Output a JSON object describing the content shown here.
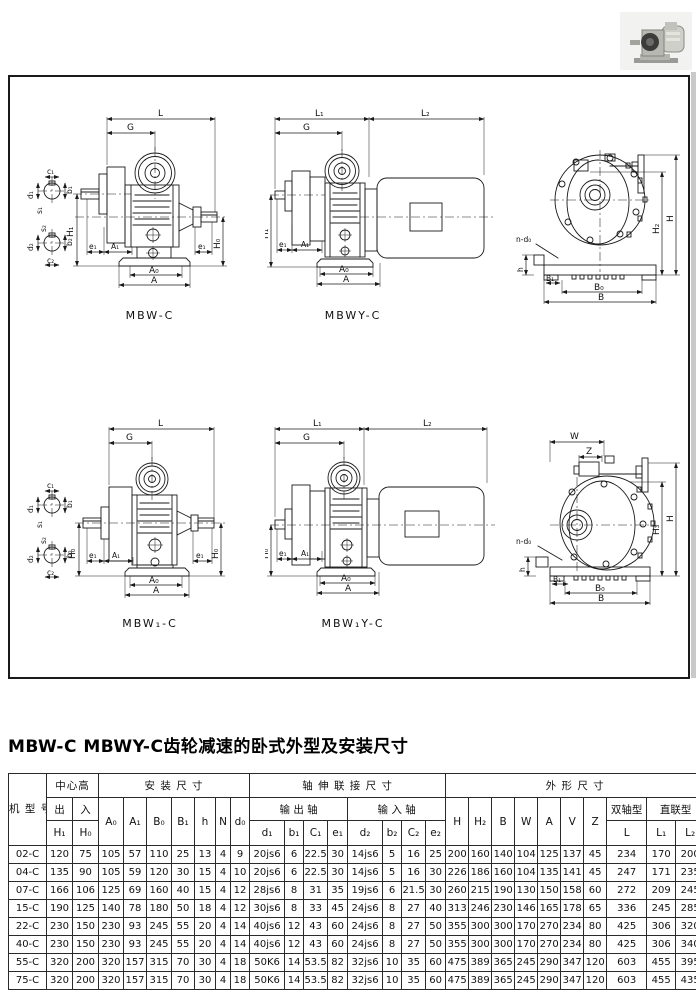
{
  "title": "MBW-C MBWY-C齿轮减速的卧式外型及安装尺寸",
  "photo": {
    "name": "gear-motor-product-photo"
  },
  "captions": {
    "mbw": "MBW-C",
    "mbwy": "MBWY-C",
    "mbw1": "MBW₁-C",
    "mbw1y": "MBW₁Y-C"
  },
  "dims": {
    "L": "L",
    "L1": "L₁",
    "L2": "L₂",
    "G": "G",
    "H1": "H₁",
    "H0": "H₀",
    "H": "H",
    "H2": "H₂",
    "H3": "H₃",
    "A": "A",
    "A0": "A₀",
    "A1": "A₁",
    "B": "B",
    "B0": "B₀",
    "B1": "B₁",
    "e1": "e₁",
    "W": "W",
    "Z": "Z",
    "h": "h",
    "n_d0": "n-d₀",
    "c1": "c₁",
    "b1": "b₁",
    "d1": "d₁",
    "s1": "s₁",
    "c2": "c₂",
    "b2": "b₂",
    "d2": "d₂",
    "s2": "s₂"
  },
  "table": {
    "groups": {
      "model": "机\n型\n号",
      "center_height": "中心高",
      "install": "安 装 尺 寸",
      "shaft": "轴 伸 联 接 尺 寸",
      "outline": "外 形 尺 寸",
      "out": "出",
      "in": "入",
      "output_shaft": "输 出 轴",
      "input_shaft": "输 入 轴",
      "double_shaft": "双轴型",
      "direct_type": "直联型"
    },
    "cols": {
      "h1": "H₁",
      "h0": "H₀",
      "a0": "A₀",
      "a1": "A₁",
      "b0": "B₀",
      "b1": "B₁",
      "h": "h",
      "n": "N",
      "d0": "d₀",
      "d1": "d₁",
      "b1s": "b₁",
      "c1": "C₁",
      "e1": "e₁",
      "d2": "d₂",
      "b2": "b₂",
      "c2": "C₂",
      "e2": "e₂",
      "H": "H",
      "H2": "H₂",
      "B": "B",
      "W": "W",
      "A": "A",
      "V": "V",
      "Z": "Z",
      "L": "L",
      "L1": "L₁",
      "L2": "L₂"
    },
    "rows": [
      [
        "02-C",
        "120",
        "75",
        "105",
        "57",
        "110",
        "25",
        "13",
        "4",
        "9",
        "20js6",
        "6",
        "22.5",
        "30",
        "14js6",
        "5",
        "16",
        "25",
        "200",
        "160",
        "140",
        "104",
        "125",
        "137",
        "45",
        "234",
        "170",
        "200"
      ],
      [
        "04-C",
        "135",
        "90",
        "105",
        "59",
        "120",
        "30",
        "15",
        "4",
        "10",
        "20js6",
        "6",
        "22.5",
        "30",
        "14js6",
        "5",
        "16",
        "30",
        "226",
        "186",
        "160",
        "104",
        "135",
        "141",
        "45",
        "247",
        "171",
        "235"
      ],
      [
        "07-C",
        "166",
        "106",
        "125",
        "69",
        "160",
        "40",
        "15",
        "4",
        "12",
        "28js6",
        "8",
        "31",
        "35",
        "19js6",
        "6",
        "21.5",
        "30",
        "260",
        "215",
        "190",
        "130",
        "150",
        "158",
        "60",
        "272",
        "209",
        "245"
      ],
      [
        "15-C",
        "190",
        "125",
        "140",
        "78",
        "180",
        "50",
        "18",
        "4",
        "12",
        "30js6",
        "8",
        "33",
        "45",
        "24js6",
        "8",
        "27",
        "40",
        "313",
        "246",
        "230",
        "146",
        "165",
        "178",
        "65",
        "336",
        "245",
        "285"
      ],
      [
        "22-C",
        "230",
        "150",
        "230",
        "93",
        "245",
        "55",
        "20",
        "4",
        "14",
        "40js6",
        "12",
        "43",
        "60",
        "24js6",
        "8",
        "27",
        "50",
        "355",
        "300",
        "300",
        "170",
        "270",
        "234",
        "80",
        "425",
        "306",
        "320"
      ],
      [
        "40-C",
        "230",
        "150",
        "230",
        "93",
        "245",
        "55",
        "20",
        "4",
        "14",
        "40js6",
        "12",
        "43",
        "60",
        "24js6",
        "8",
        "27",
        "50",
        "355",
        "300",
        "300",
        "170",
        "270",
        "234",
        "80",
        "425",
        "306",
        "340"
      ],
      [
        "55-C",
        "320",
        "200",
        "320",
        "157",
        "315",
        "70",
        "30",
        "4",
        "18",
        "50K6",
        "14",
        "53.5",
        "82",
        "32js6",
        "10",
        "35",
        "60",
        "475",
        "389",
        "365",
        "245",
        "290",
        "347",
        "120",
        "603",
        "455",
        "395"
      ],
      [
        "75-C",
        "320",
        "200",
        "320",
        "157",
        "315",
        "70",
        "30",
        "4",
        "18",
        "50K6",
        "14",
        "53.5",
        "82",
        "32js6",
        "10",
        "35",
        "60",
        "475",
        "389",
        "365",
        "245",
        "290",
        "347",
        "120",
        "603",
        "455",
        "435"
      ]
    ]
  }
}
